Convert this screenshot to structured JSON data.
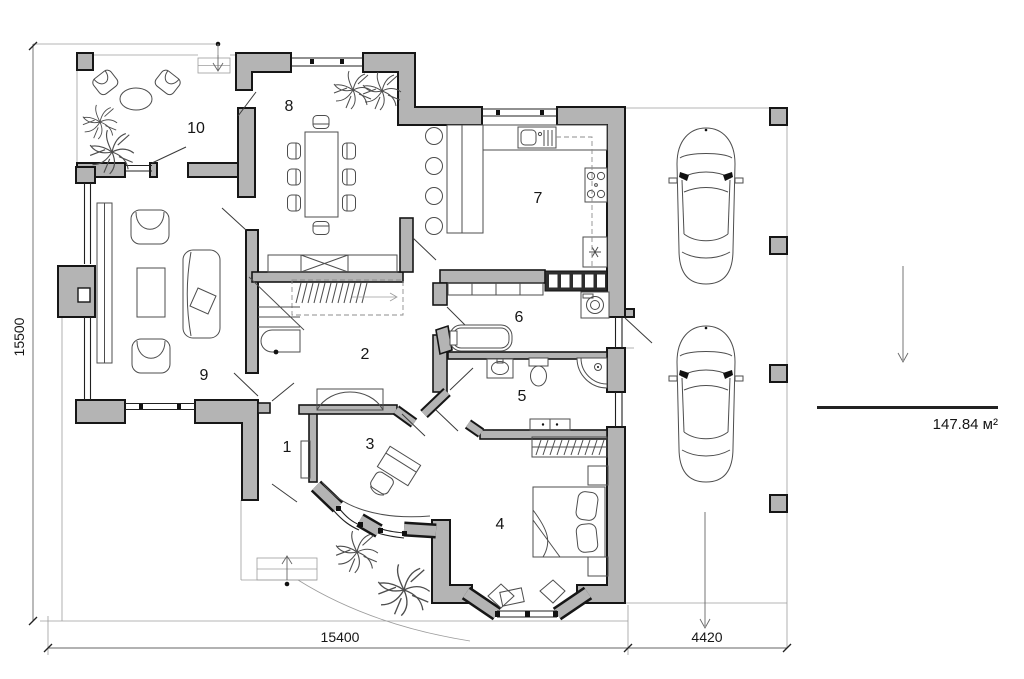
{
  "rooms": {
    "r1": "1",
    "r2": "2",
    "r3": "3",
    "r4": "4",
    "r5": "5",
    "r6": "6",
    "r7": "7",
    "r8": "8",
    "r9": "9",
    "r10": "10"
  },
  "dimensions": {
    "left": "15500",
    "bottom_main": "15400",
    "bottom_side": "4420"
  },
  "area": {
    "value": "147.84 м²"
  },
  "symbols": {
    "car": "car-top-view-icon",
    "plant": "plant-icon",
    "bed": "bed-icon",
    "wardrobe": "wardrobe-icon",
    "bathtub": "bathtub-icon",
    "toilet": "toilet-icon",
    "washbasin": "washbasin-icon",
    "shower": "corner-shower-icon",
    "washing_machine": "washing-machine-icon",
    "kitchen_sink": "kitchen-sink-icon",
    "stove": "stove-icon",
    "fridge": "fridge-icon",
    "dining_table": "dining-table-icon",
    "sofa": "sofa-icon",
    "armchair": "armchair-icon",
    "coffee_table": "coffee-table-icon",
    "desk": "desk-icon",
    "stairs": "staircase-icon",
    "entrance_arrow": "entrance-arrow-icon",
    "carport_post": "carport-post-icon"
  },
  "colors": {
    "wall_fill": "#b4b4b4",
    "wall_stroke": "#161616",
    "background": "#ffffff",
    "annotation": "#161616"
  }
}
